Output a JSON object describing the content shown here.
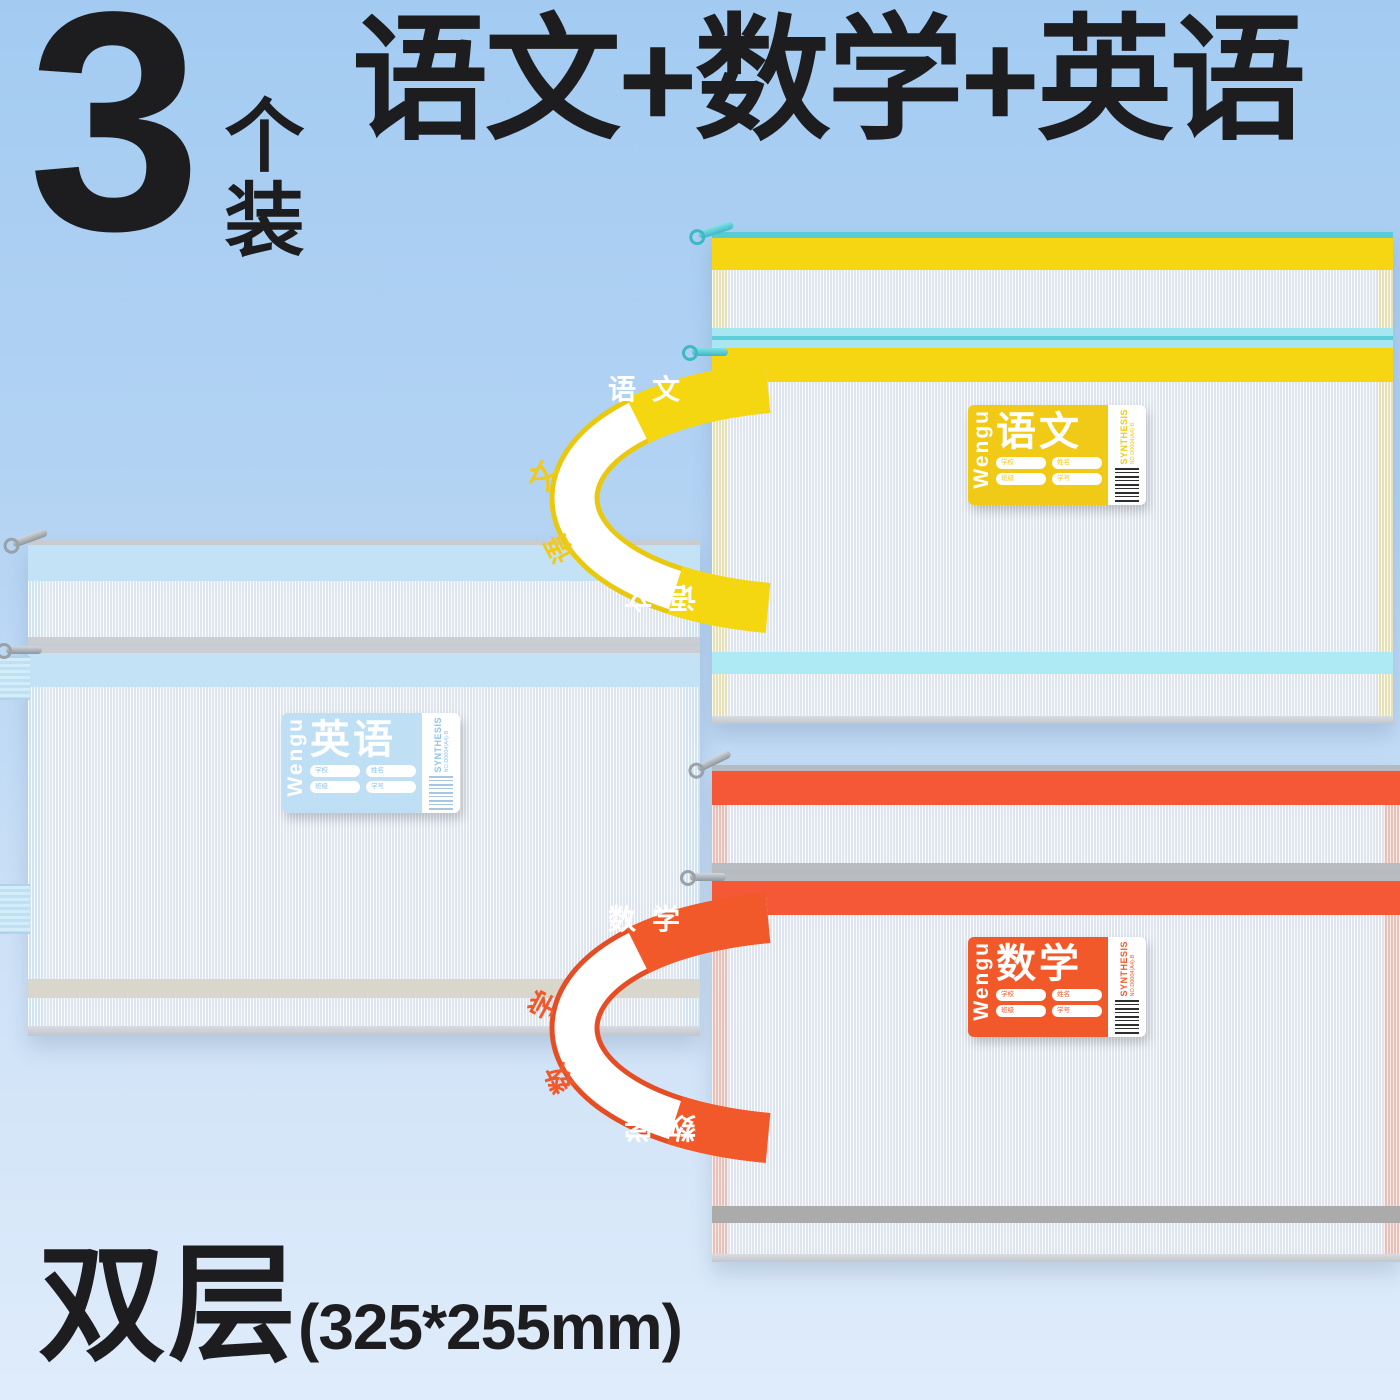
{
  "badge": {
    "number": "3",
    "unit": "个装"
  },
  "title": "语文+数学+英语",
  "footer": {
    "label": "双层",
    "size": "(325*255mm)"
  },
  "colors": {
    "background_top": "#A3CBF2",
    "background_bottom": "#DFECFB",
    "text": "#1D1D1F",
    "chinese_accent": "#F5D711",
    "chinese_zipper": "#57CCD6",
    "math_accent": "#F4593A",
    "english_accent": "#BFDFF5"
  },
  "bags": [
    {
      "name": "chinese",
      "subject": "语文",
      "subject_chars": [
        "语",
        "文"
      ],
      "brand": "Wengu",
      "side_text": "SYNTHESIS",
      "side_code": "NO.D0004(A4)-B",
      "fields": [
        "学校",
        "姓名",
        "班级",
        "学号"
      ]
    },
    {
      "name": "math",
      "subject": "数学",
      "subject_chars": [
        "数",
        "学"
      ],
      "brand": "Wengu",
      "side_text": "SYNTHESIS",
      "side_code": "NO.D0004(A4)-B",
      "fields": [
        "学校",
        "姓名",
        "班级",
        "学号"
      ]
    },
    {
      "name": "english",
      "subject": "英语",
      "subject_chars": [
        "英",
        "语"
      ],
      "brand": "Wengu",
      "side_text": "SYNTHESIS",
      "side_code": "NO.D0004(A4)-B",
      "fields": [
        "学校",
        "姓名",
        "班级",
        "学号"
      ]
    }
  ]
}
